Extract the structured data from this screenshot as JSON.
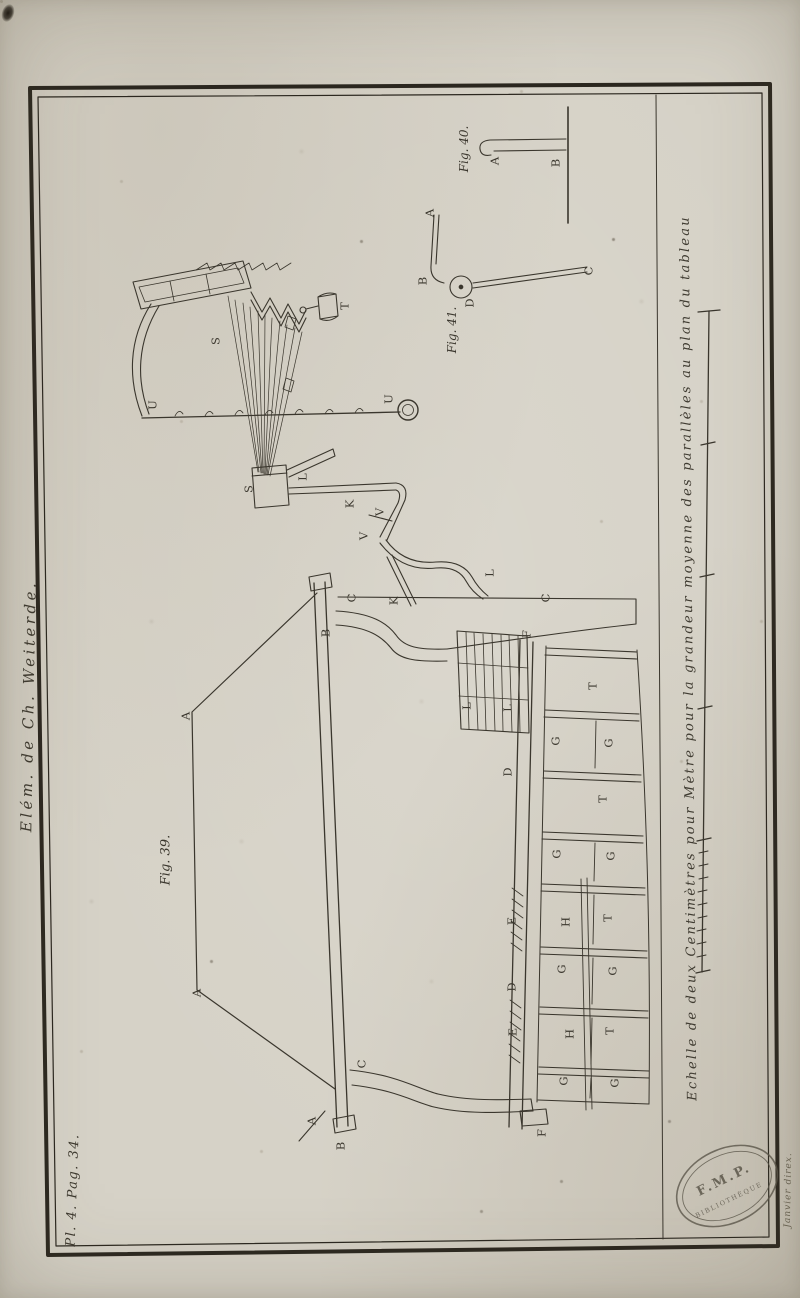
{
  "page": {
    "spine_text": "Elém. de Ch. Weiterde.",
    "plate_ref": "Pl. 4. Pag. 34.",
    "engraver_signature": "Janvier direx.",
    "stamp": {
      "line1": "F.M.P.",
      "line2": "BIBLIOTHÈQUE"
    }
  },
  "scale": {
    "caption": "Echelle de deux Centimètres pour Mètre pour la grandeur moyenne des parallèles au plan du tableau"
  },
  "fig39": {
    "label": "Fig. 39.",
    "letters": {
      "a1": "A",
      "a2": "A",
      "a3": "A",
      "b1": "B",
      "b2": "B",
      "c1": "C",
      "c2": "C",
      "c3": "C",
      "d1": "D",
      "d2": "D",
      "e1": "E",
      "e2": "E",
      "f1": "F",
      "f2": "F",
      "g1": "G",
      "g2": "G",
      "g3": "G",
      "g4": "G",
      "g5": "G",
      "g6": "G",
      "g7": "G",
      "g8": "G",
      "h1": "H",
      "h2": "H",
      "k1": "K",
      "k2": "K",
      "l1": "L",
      "l2": "L",
      "l3": "L",
      "l4": "L",
      "s1": "S",
      "s2": "S",
      "t0": "T",
      "t1": "T",
      "t2": "T",
      "t3": "T",
      "t4": "T",
      "u1": "U",
      "u2": "U",
      "v1": "V",
      "v2": "V"
    }
  },
  "fig40": {
    "label": "Fig. 40.",
    "letters": {
      "a": "A",
      "b": "B"
    }
  },
  "fig41": {
    "label": "Fig. 41.",
    "letters": {
      "a": "A",
      "b": "B",
      "c": "C",
      "d": "D"
    }
  }
}
